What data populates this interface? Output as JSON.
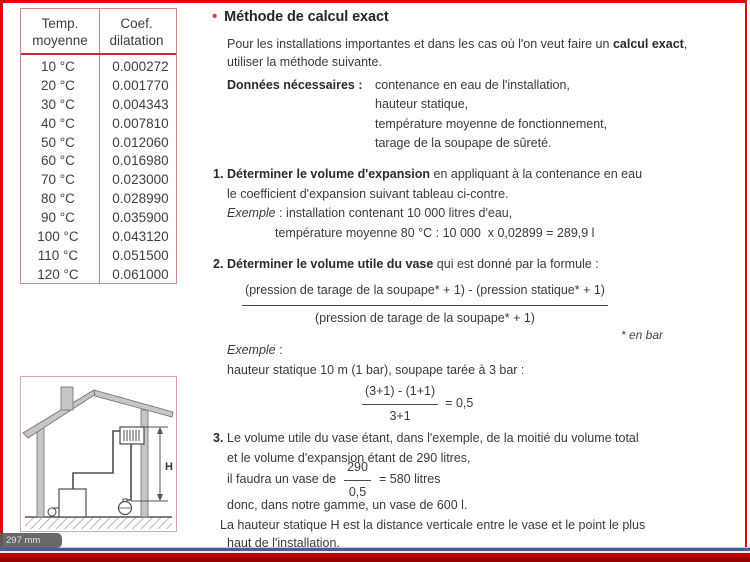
{
  "colors": {
    "frame_red": "#e8000a",
    "table_border": "#d48a8a",
    "table_rule_red": "#c5303f",
    "bullet_red": "#e23a4f",
    "body_text": "#3a3a3a",
    "bottom_blue_line": "#44609c",
    "bottom_red_bar": "#b00202",
    "diagram_border": "#e2a0a8"
  },
  "viewer": {
    "size_tooltip": "297 mm"
  },
  "table": {
    "headers": [
      {
        "line1": "Temp.",
        "line2": "moyenne"
      },
      {
        "line1": "Coef.",
        "line2": "dilatation"
      }
    ],
    "rows": [
      {
        "temp": "10 °C",
        "coef": "0.000272"
      },
      {
        "temp": "20 °C",
        "coef": "0.001770"
      },
      {
        "temp": "30 °C",
        "coef": "0.004343"
      },
      {
        "temp": "40 °C",
        "coef": "0.007810"
      },
      {
        "temp": "50 °C",
        "coef": "0.012060"
      },
      {
        "temp": "60 °C",
        "coef": "0.016980"
      },
      {
        "temp": "70 °C",
        "coef": "0.023000"
      },
      {
        "temp": "80 °C",
        "coef": "0.028990"
      },
      {
        "temp": "90 °C",
        "coef": "0.035900"
      },
      {
        "temp": "100 °C",
        "coef": "0.043120"
      },
      {
        "temp": "110 °C",
        "coef": "0.051500"
      },
      {
        "temp": "120 °C",
        "coef": "0.061000"
      }
    ]
  },
  "diagram": {
    "height_label": "H"
  },
  "content": {
    "bullet": "•",
    "title": "Méthode de calcul exact",
    "intro": {
      "line1_pre": "Pour les installations importantes et dans les cas où l'on veut faire un ",
      "line1_bold": "calcul exact",
      "line1_post": ",",
      "line2": "utiliser la méthode suivante."
    },
    "required_data": {
      "label": "Données nécessaires :",
      "items": [
        "contenance en eau de l'installation,",
        "hauteur statique,",
        "température moyenne de fonctionnement,",
        "tarage de la soupape de sûreté."
      ]
    },
    "step1": {
      "number": "1.",
      "bold": "Déterminer le volume d'expansion",
      "line1_rest": " en appliquant à la contenance en eau",
      "line2": "le coefficient d'expansion suivant tableau ci-contre.",
      "example_label": "Exemple",
      "example_rest": " : installation contenant 10 000 litres d'eau,",
      "example_line2": "température moyenne 80 °C : 10 000  x 0,02899 = 289,9 l"
    },
    "step2": {
      "number": "2.",
      "bold": "Déterminer le volume utile du vase",
      "line1_rest": " qui est donné par la formule :",
      "formula_numerator": "(pression de tarage de la soupape* + 1) - (pression statique* + 1)",
      "formula_denominator": "(pression de tarage de la soupape* + 1)",
      "footnote": "* en bar",
      "example_label": "Exemple",
      "example_colon": " :",
      "example_line": "hauteur statique 10 m (1 bar), soupape tarée à 3 bar :",
      "calc_numerator": "(3+1) - (1+1)",
      "calc_denominator": "3+1",
      "calc_result": "= 0,5"
    },
    "step3": {
      "number": "3.",
      "line1": "Le volume utile du vase étant, dans l'exemple, de la moitié du volume total",
      "line2": "et le volume d'expansion étant de 290 litres,",
      "line3_pre": "il faudra un vase de",
      "calc_numerator": "290",
      "calc_denominator": "0,5",
      "line3_post": "= 580 litres",
      "line4": "donc, dans notre gamme, un vase de 600 l."
    },
    "footer": {
      "line1": "La hauteur statique H est la distance verticale entre le vase et le point le plus",
      "line2": "haut de l'installation."
    }
  }
}
